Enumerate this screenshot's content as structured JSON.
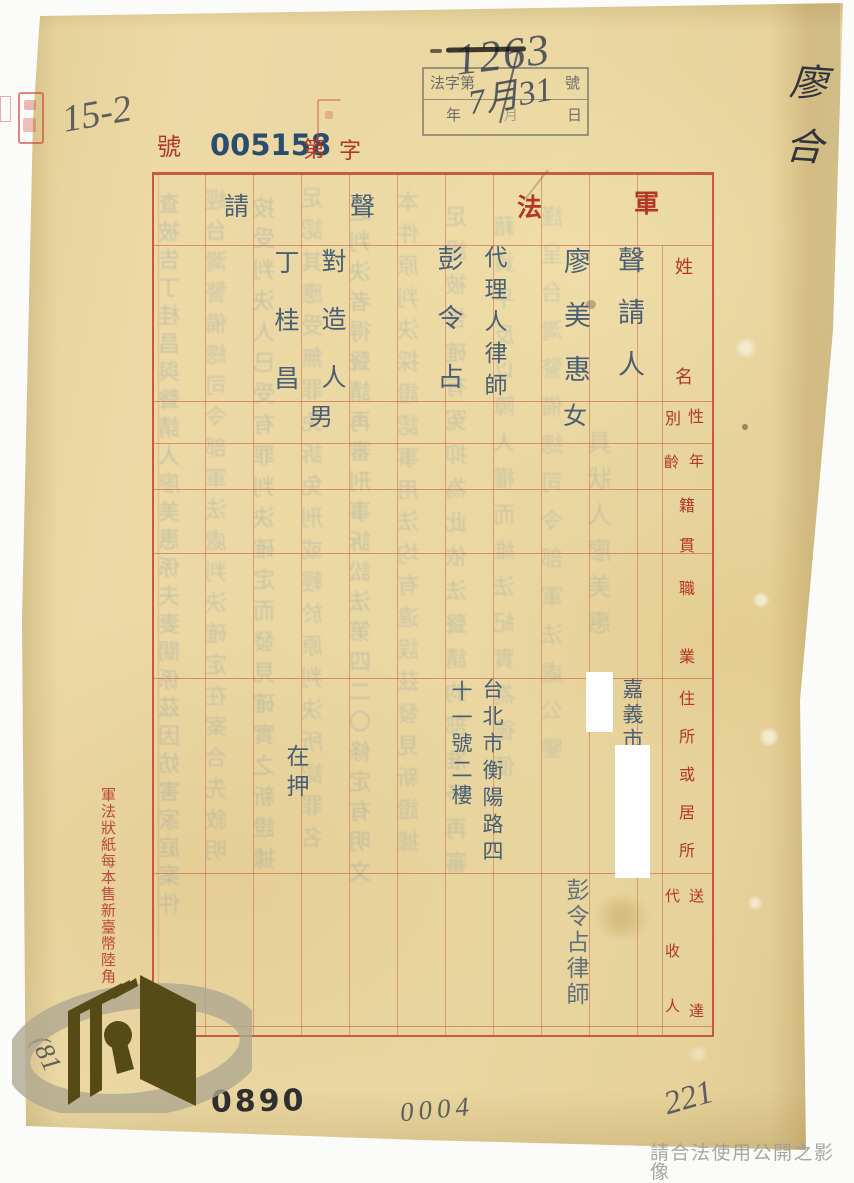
{
  "colors": {
    "paper": "#e8d5a0",
    "grid_red": "#c05036",
    "print_red": "#b23726",
    "typed_blue": "#4a5f74",
    "stamp_blue": "#2b4c6d",
    "ink": "#373e50",
    "pencil": "#5d5f5c",
    "logo_olive": "#564b17"
  },
  "stamps": {
    "serial": {
      "hao": "號",
      "number": "005158",
      "di": "第",
      "zi": "字"
    },
    "case_box": {
      "label": "法字第",
      "hao": "號",
      "year": "年",
      "month": "月",
      "day": "日",
      "hand_number": "1263",
      "hand_date": "7月31"
    }
  },
  "annotations": {
    "top_left_pencil": "15-2",
    "top_right_pen": "廖合",
    "bottom_stamp": "0890",
    "bottom_pencil": "0004",
    "bottom_right_pencil": "221",
    "bottom_left_pencil": "(81",
    "watermark": "請合法使用公開之影像"
  },
  "form": {
    "title": {
      "jun": "軍",
      "fa": "法",
      "sheng": "聲",
      "qing": "請"
    },
    "headers": {
      "name": "姓名",
      "sex_right": "性",
      "sex_left": "別",
      "age_right": "年",
      "age_left": "齡",
      "origin": "籍貫",
      "occupation": "職業",
      "address": "住所或居所",
      "agent_right": "送達",
      "agent_left": "代收人"
    },
    "side_note": "軍法狀紙每本售新臺幣陸角",
    "entries": {
      "petitioner": {
        "role": "聲請人",
        "name": "廖美惠",
        "sex": "女",
        "address": "嘉義市",
        "service_agent": "彭令占律師"
      },
      "attorney": {
        "role": "代理人律師",
        "name": "彭令占",
        "address_col1": "台北市衡陽路四",
        "address_col2": "十一號二樓"
      },
      "opponent": {
        "role": "對造人",
        "name": "丁桂昌",
        "sex": "男",
        "address": "在押"
      }
    }
  },
  "bleedthrough": {
    "columns": [
      "查被告丁桂昌與聲請人廖美惠係夫妻關係茲因妨害家庭案件",
      "經台灣警備總司令部軍法處判決確定在案合先敘明",
      "按受判決人已受有罪判決確定而發見確實之新證據",
      "足認其應受無罪免訴免刑或輕於原判決所認罪名",
      "之判決者得聲請再審刑事訴訟法第四二〇條定有明文",
      "本件原判決採證認事用法均有違誤茲發見新證據",
      "足證被告確有冤抑為此依法聲請鈞部准予再審",
      "藉資平反以障人權而維法紀實為德便",
      "謹呈台灣警備總司令部軍法處公鑒",
      "具狀人廖美惠"
    ]
  }
}
